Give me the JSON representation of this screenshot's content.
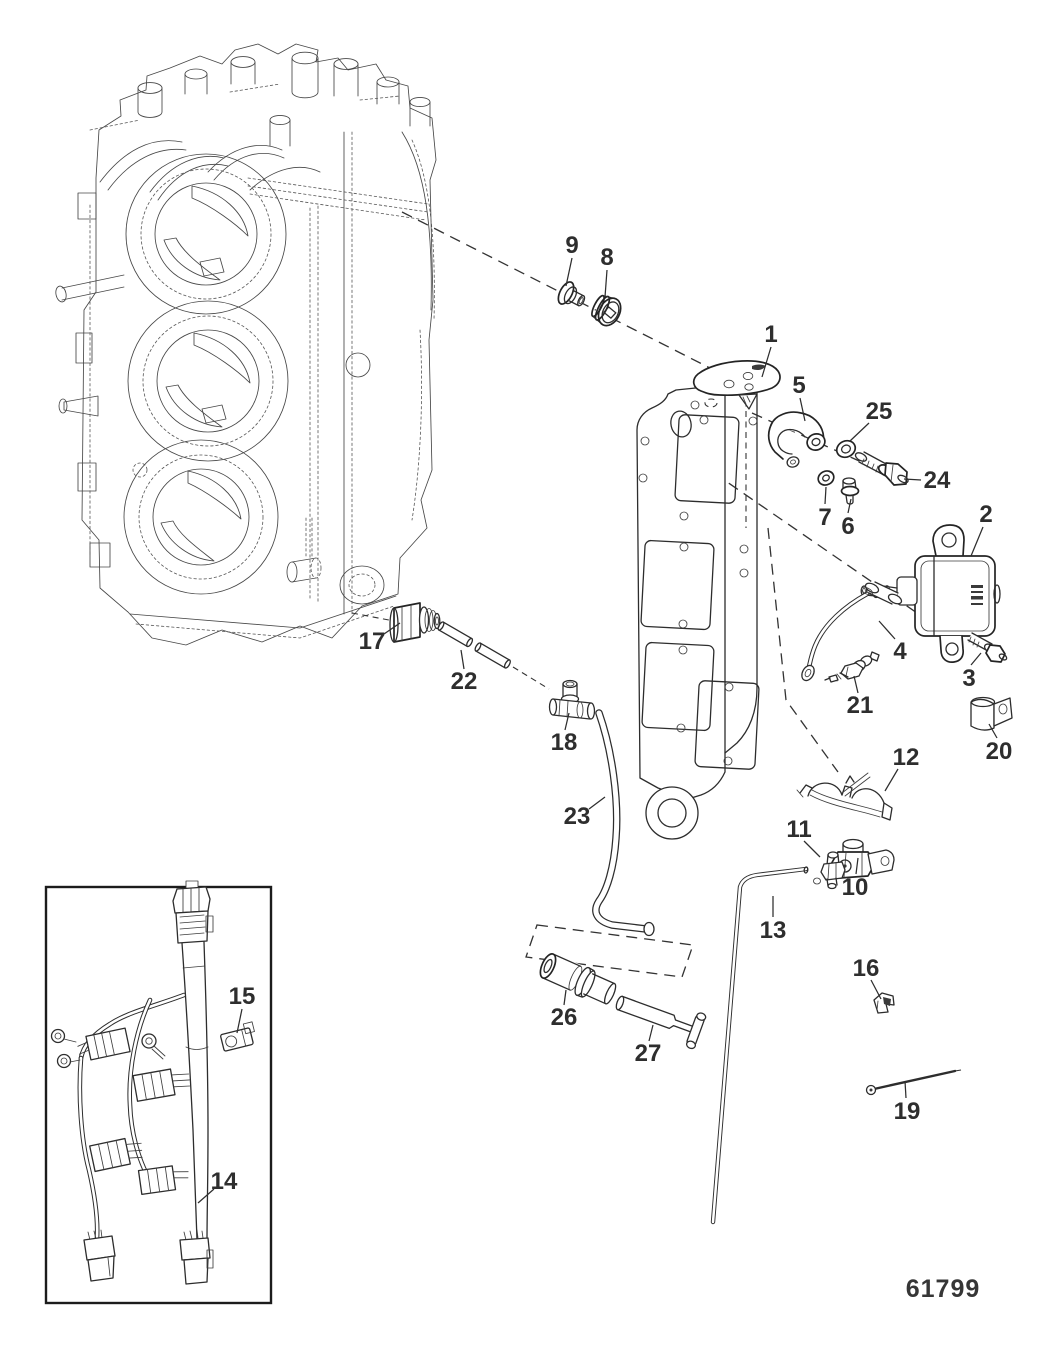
{
  "diagram": {
    "drawing_number": "61799",
    "callouts": [
      {
        "label": "1",
        "x": 771,
        "y": 334,
        "leader": [
          771,
          347,
          762,
          377
        ]
      },
      {
        "label": "2",
        "x": 986,
        "y": 514,
        "leader": [
          983,
          527,
          971,
          556
        ]
      },
      {
        "label": "3",
        "x": 969,
        "y": 678,
        "leader": [
          971,
          665,
          981,
          653
        ]
      },
      {
        "label": "4",
        "x": 900,
        "y": 651,
        "leader": [
          895,
          639,
          879,
          621
        ]
      },
      {
        "label": "5",
        "x": 799,
        "y": 385,
        "leader": [
          800,
          398,
          805,
          421
        ]
      },
      {
        "label": "6",
        "x": 848,
        "y": 526,
        "leader": [
          848,
          513,
          851,
          499
        ]
      },
      {
        "label": "7",
        "x": 825,
        "y": 517,
        "leader": [
          825,
          504,
          826,
          487
        ]
      },
      {
        "label": "8",
        "x": 607,
        "y": 257,
        "leader": [
          607,
          270,
          605,
          297
        ]
      },
      {
        "label": "9",
        "x": 572,
        "y": 245,
        "leader": [
          572,
          258,
          566,
          286
        ]
      },
      {
        "label": "10",
        "x": 855,
        "y": 887,
        "leader": [
          856,
          874,
          858,
          858
        ]
      },
      {
        "label": "11",
        "x": 799,
        "y": 829,
        "leader": [
          804,
          841,
          820,
          857
        ]
      },
      {
        "label": "12",
        "x": 906,
        "y": 757,
        "leader": [
          898,
          769,
          885,
          791
        ]
      },
      {
        "label": "13",
        "x": 773,
        "y": 930,
        "leader": [
          773,
          917,
          773,
          896
        ]
      },
      {
        "label": "14",
        "x": 224,
        "y": 1181,
        "leader": [
          214,
          1189,
          198,
          1203
        ]
      },
      {
        "label": "15",
        "x": 242,
        "y": 996,
        "leader": [
          242,
          1009,
          237,
          1033
        ]
      },
      {
        "label": "16",
        "x": 866,
        "y": 968,
        "leader": [
          871,
          980,
          881,
          999
        ]
      },
      {
        "label": "17",
        "x": 372,
        "y": 641,
        "leader": [
          384,
          634,
          400,
          623
        ]
      },
      {
        "label": "18",
        "x": 564,
        "y": 742,
        "leader": [
          565,
          730,
          569,
          713
        ]
      },
      {
        "label": "19",
        "x": 907,
        "y": 1111,
        "leader": [
          906,
          1098,
          905,
          1081
        ]
      },
      {
        "label": "20",
        "x": 999,
        "y": 751,
        "leader": [
          997,
          738,
          989,
          724
        ]
      },
      {
        "label": "21",
        "x": 860,
        "y": 705,
        "leader": [
          858,
          693,
          854,
          676
        ]
      },
      {
        "label": "22",
        "x": 464,
        "y": 681,
        "leader": [
          464,
          669,
          461,
          650
        ]
      },
      {
        "label": "23",
        "x": 577,
        "y": 816,
        "leader": [
          589,
          809,
          605,
          797
        ]
      },
      {
        "label": "24",
        "x": 937,
        "y": 480,
        "leader": [
          921,
          480,
          904,
          479
        ]
      },
      {
        "label": "25",
        "x": 879,
        "y": 411,
        "leader": [
          869,
          423,
          850,
          441
        ]
      },
      {
        "label": "26",
        "x": 564,
        "y": 1017,
        "leader": [
          564,
          1005,
          566,
          990
        ]
      },
      {
        "label": "27",
        "x": 648,
        "y": 1053,
        "leader": [
          649,
          1041,
          653,
          1025
        ]
      }
    ]
  }
}
